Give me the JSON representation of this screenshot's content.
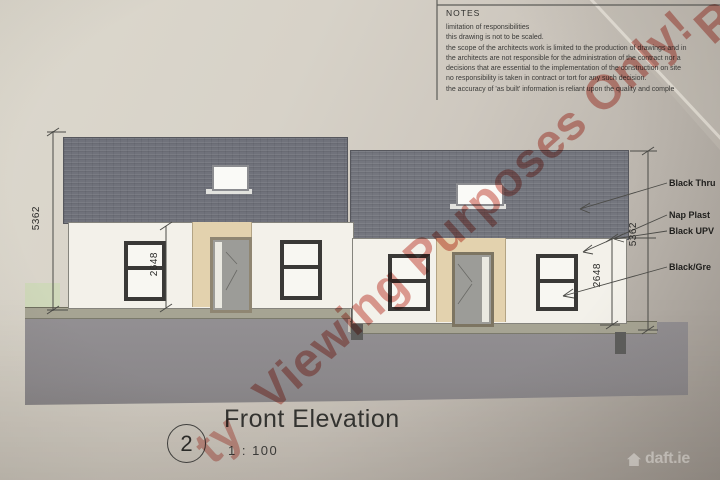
{
  "notes": {
    "title": "NOTES",
    "lines": [
      "limitation of responsibilities",
      "this drawing is not to be scaled.",
      "the scope of the architects work is limited to the production of drawings and in",
      "the architects are not responsible for the administration of the contract  nor  a",
      "decisions that are essential to the implementation of the construction on  site",
      "no responsibility is taken in contract or  tort for any such decision.",
      "the accuracy of 'as built'  information is reliant  upon the quality and  comple"
    ]
  },
  "annotations": {
    "roof_label": "Black Thru",
    "wall_label": "Nap Plast",
    "gutter_label": "Black UPV",
    "window_label": "Black/Gre"
  },
  "dimensions": {
    "overall_height_left": "5362",
    "wall_height_left": "2648",
    "wall_height_right": "2648",
    "overall_height_right": "5362"
  },
  "title_block": {
    "drawing_number": "2",
    "title": "Front Elevation",
    "scale": "1 : 100"
  },
  "watermark": {
    "text": "Viewing Purposes Only!",
    "fragment_top_right": "R",
    "fragment_bottom_left": "ty",
    "color": "#c33e30"
  },
  "brand": {
    "logo_text": "daft.ie"
  },
  "colors": {
    "roof": "#70727b",
    "wall": "#f3f1ea",
    "door_surround": "#e3d2ae",
    "footpath": "#a6a493",
    "ground": "#8e8b8e",
    "grass": "#cfd8ba"
  }
}
